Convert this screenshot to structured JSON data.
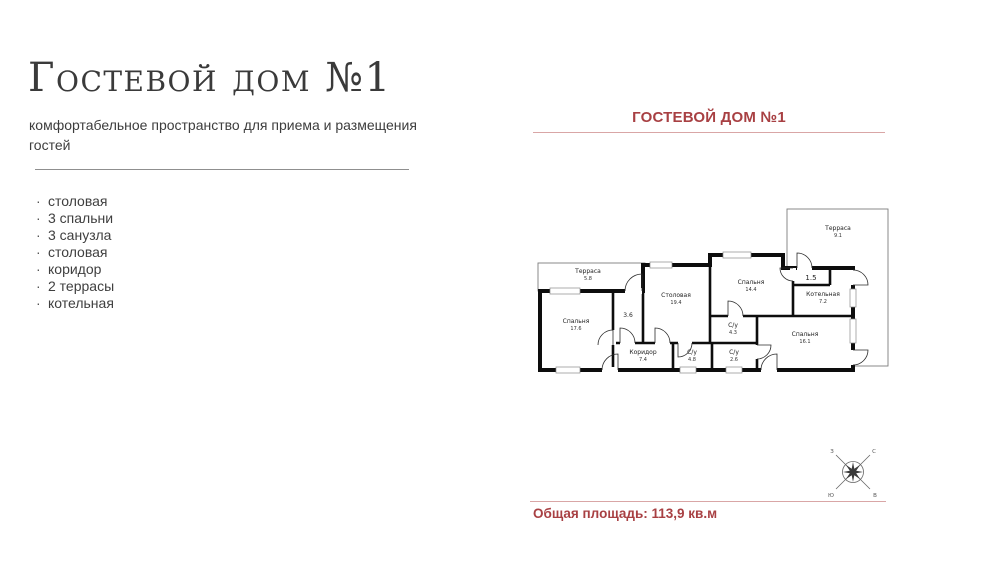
{
  "left": {
    "title": "Гостевой дом №1",
    "subtitle": "комфортабельное пространство для приема и размещения гостей",
    "bullet": "·",
    "features": [
      {
        "label": "столовая"
      },
      {
        "label": "3 спальни"
      },
      {
        "label": "3 санузла"
      },
      {
        "label": "столовая"
      },
      {
        "label": "коридор"
      },
      {
        "label": "2 террасы"
      },
      {
        "label": "котельная"
      }
    ]
  },
  "plan": {
    "title": "ГОСТЕВОЙ ДОМ №1",
    "total_area": "Общая площадь: 113,9 кв.м",
    "accent_color": "#a84043",
    "line_color": "#d9a6a6",
    "rooms": [
      {
        "name": "Терраса",
        "area": "5.8"
      },
      {
        "name": "Спальня",
        "area": "17.6"
      },
      {
        "name": "",
        "area": "3.6"
      },
      {
        "name": "Столовая",
        "area": "19.4"
      },
      {
        "name": "Спальня",
        "area": "14.4"
      },
      {
        "name": "С/у",
        "area": "4.3"
      },
      {
        "name": "Коридор",
        "area": "7.4"
      },
      {
        "name": "С/у",
        "area": "4.8"
      },
      {
        "name": "С/у",
        "area": "2.6"
      },
      {
        "name": "Спальня",
        "area": "16.1"
      },
      {
        "name": "",
        "area": "1.5"
      },
      {
        "name": "Котельная",
        "area": "7.2"
      },
      {
        "name": "Терраса",
        "area": "9.1"
      }
    ],
    "compass": {
      "w": "З",
      "n": "С",
      "s": "Ю",
      "e": "В"
    }
  }
}
